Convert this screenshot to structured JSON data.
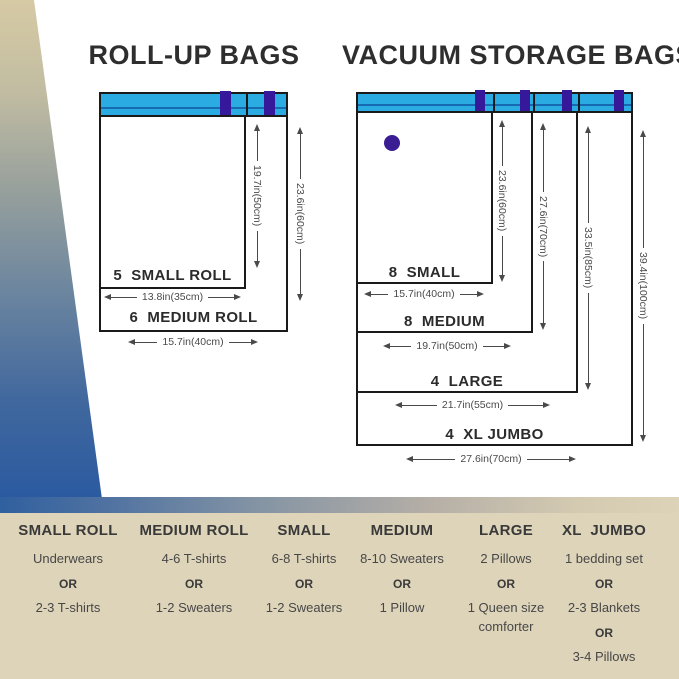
{
  "roll_up": {
    "title": "ROLL-UP BAGS",
    "small": {
      "label": "5  SMALL ROLL",
      "width": "13.8in(35cm)",
      "height": "19.7in(50cm)"
    },
    "medium": {
      "label": "6  MEDIUM ROLL",
      "width": "15.7in(40cm)",
      "height": "23.6in(60cm)"
    }
  },
  "vacuum": {
    "title": "VACUUM STORAGE BAGS",
    "small": {
      "label": "8  SMALL",
      "width": "15.7in(40cm)",
      "height": "23.6in(60cm)"
    },
    "medium": {
      "label": "8  MEDIUM",
      "width": "19.7in(50cm)",
      "height": "27.6in(70cm)"
    },
    "large": {
      "label": "4  LARGE",
      "width": "21.7in(55cm)",
      "height": "33.5in(85cm)"
    },
    "xl": {
      "label": "4  XL JUMBO",
      "width": "27.6in(70cm)",
      "height": "39.4in(100cm)"
    }
  },
  "capacity": {
    "columns": [
      {
        "header": "SMALL ROLL",
        "items": [
          "Underwears",
          "OR",
          "2-3 T-shirts"
        ]
      },
      {
        "header": "MEDIUM ROLL",
        "items": [
          "4-6 T-shirts",
          "OR",
          "1-2 Sweaters"
        ]
      },
      {
        "header": "SMALL",
        "items": [
          "6-8 T-shirts",
          "OR",
          "1-2 Sweaters"
        ]
      },
      {
        "header": "MEDIUM",
        "items": [
          "8-10 Sweaters",
          "OR",
          "1 Pillow"
        ]
      },
      {
        "header": "LARGE",
        "items": [
          "2 Pillows",
          "OR",
          "1 Queen size comforter"
        ]
      },
      {
        "header": "XL  JUMBO",
        "items": [
          "1 bedding set",
          "OR",
          "2-3 Blankets",
          "OR",
          "3-4 Pillows"
        ]
      }
    ]
  },
  "colors": {
    "strip_blue": "#2aace3",
    "strip_inner_line": "#156ab2",
    "clip_purple": "#36189a",
    "valve_purple": "#3a1d92",
    "panel_tan": "#ded4ba",
    "gradient_top_tan": "#d6caa4",
    "gradient_bottom_blue": "#2b5aa0",
    "outline_black": "#1a1a1a"
  }
}
